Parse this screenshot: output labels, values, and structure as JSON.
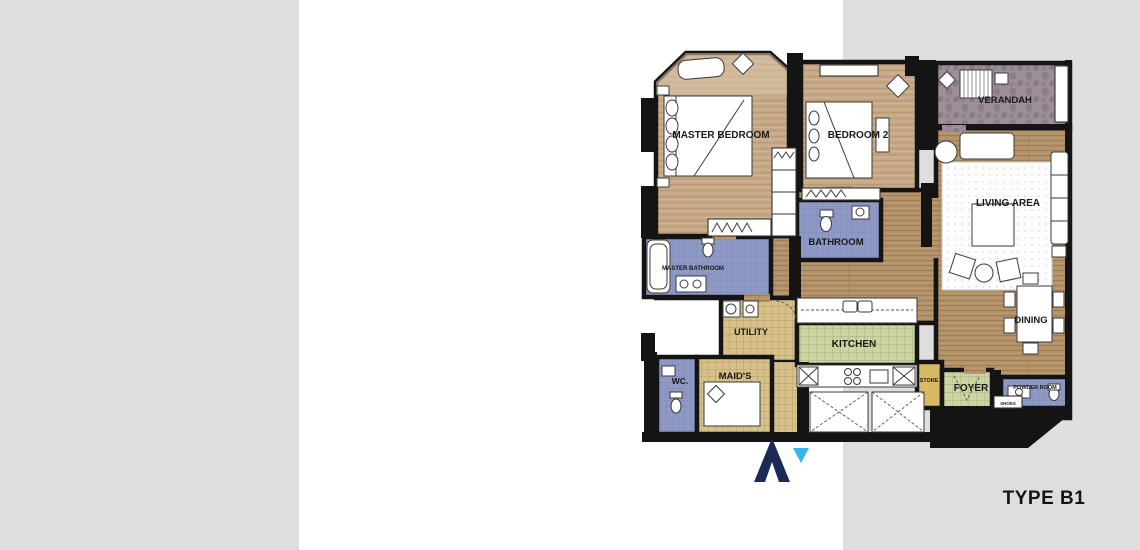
{
  "page": {
    "background": "#dedede",
    "panel_background": "#ffffff"
  },
  "plan": {
    "title": "TYPE B1",
    "rooms": [
      {
        "id": "master-bedroom",
        "label": "MASTER BEDROOM"
      },
      {
        "id": "bedroom-2",
        "label": "BEDROOM 2"
      },
      {
        "id": "verandah",
        "label": "VERANDAH"
      },
      {
        "id": "living-area",
        "label": "LIVING AREA"
      },
      {
        "id": "bathroom",
        "label": "BATHROOM"
      },
      {
        "id": "master-bathroom",
        "label": "MASTER BATHROOM"
      },
      {
        "id": "utility",
        "label": "UTILITY"
      },
      {
        "id": "kitchen",
        "label": "KITCHEN"
      },
      {
        "id": "dining",
        "label": "DINING"
      },
      {
        "id": "wc",
        "label": "WC."
      },
      {
        "id": "maids-room",
        "label": "MAID'S"
      },
      {
        "id": "store",
        "label": "STORE"
      },
      {
        "id": "foyer",
        "label": "FOYER"
      },
      {
        "id": "powder-room",
        "label": "POWDER ROOM"
      },
      {
        "id": "shoes-cabinet",
        "label": "SHOES"
      }
    ],
    "colors": {
      "wall": "#141414",
      "wood_floor": "#b29068",
      "bedroom_floor": "#c6a987",
      "bathroom_blue": "#8e99c4",
      "kitchen_green": "#cbd4a3",
      "utility_khaki": "#d6c189",
      "verandah_stone": "#9d8f9a",
      "store_tan": "#d9b964"
    }
  },
  "logo": {
    "navy": "#1b2a55",
    "cyan": "#35b6ea"
  }
}
